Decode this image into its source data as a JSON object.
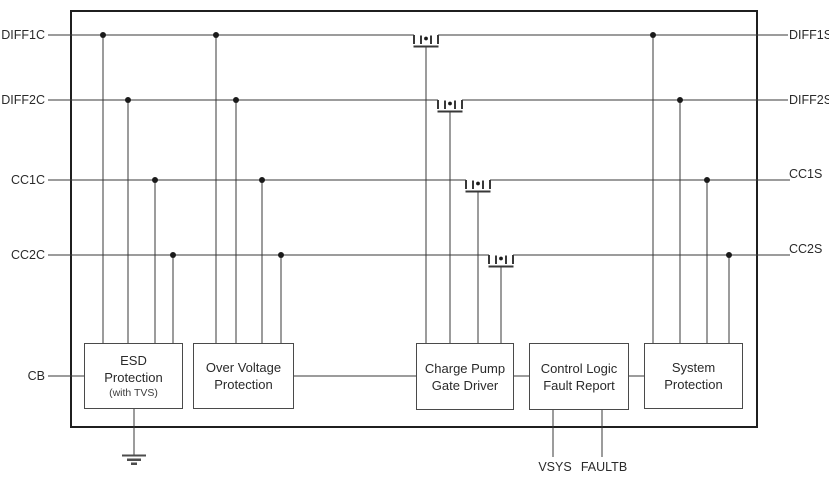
{
  "pins": {
    "left": [
      {
        "label": "DIFF1C"
      },
      {
        "label": "DIFF2C"
      },
      {
        "label": "CC1C"
      },
      {
        "label": "CC2C"
      },
      {
        "label": "CB"
      }
    ],
    "right": [
      {
        "label": "DIFF1S"
      },
      {
        "label": "DIFF2S"
      },
      {
        "label": "CC1S"
      },
      {
        "label": "CC2S"
      }
    ],
    "bottom": [
      {
        "label": "VSYS"
      },
      {
        "label": "FAULTB"
      }
    ]
  },
  "blocks": {
    "esd": {
      "lines": [
        "ESD",
        "Protection",
        "(with TVS)"
      ]
    },
    "over_voltage": {
      "lines": [
        "Over Voltage",
        "Protection"
      ]
    },
    "charge_pump": {
      "lines": [
        "Charge Pump",
        "Gate Driver"
      ]
    },
    "control_logic": {
      "lines": [
        "Control Logic",
        "Fault Report"
      ]
    },
    "system_protection": {
      "lines": [
        "System",
        "Protection"
      ]
    }
  },
  "colors": {
    "wire": "#383838",
    "box_border": "#1f1f1f",
    "block_border": "#4a4a4a",
    "text": "#2a2a2a",
    "background": "#ffffff"
  }
}
